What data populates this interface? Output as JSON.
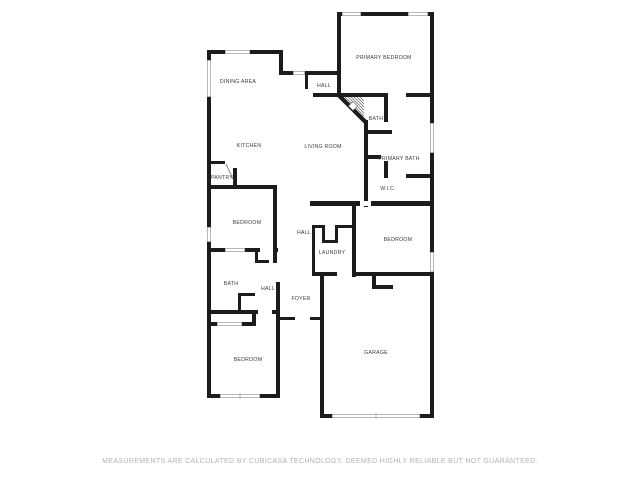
{
  "meta": {
    "width": 640,
    "height": 480
  },
  "colors": {
    "background": "#ffffff",
    "wall": "#1c1c1c",
    "label": "#3a3a3a",
    "window_line": "#999999",
    "stairs_line": "#555555",
    "footer_text": "#b3b3b3"
  },
  "floor_plan": {
    "rooms": [
      {
        "id": "dining-area",
        "label": "DINING AREA",
        "x": 238,
        "y": 81
      },
      {
        "id": "hall-upper",
        "label": "HALL",
        "x": 324,
        "y": 85
      },
      {
        "id": "primary-bedroom",
        "label": "PRIMARY BEDROOM",
        "x": 384,
        "y": 57
      },
      {
        "id": "kitchen",
        "label": "KITCHEN",
        "x": 249,
        "y": 145
      },
      {
        "id": "living-room",
        "label": "LIVING ROOM",
        "x": 323,
        "y": 146
      },
      {
        "id": "bath-suite",
        "label": "BATH",
        "x": 376,
        "y": 118
      },
      {
        "id": "primary-bath",
        "label": "PRIMARY BATH",
        "x": 399,
        "y": 158
      },
      {
        "id": "wic",
        "label": "W.I.C.",
        "x": 388,
        "y": 188
      },
      {
        "id": "pantry",
        "label": "PANTRY",
        "x": 222,
        "y": 177
      },
      {
        "id": "bedroom-left",
        "label": "BEDROOM",
        "x": 247,
        "y": 222
      },
      {
        "id": "hall-middle",
        "label": "HALL",
        "x": 304,
        "y": 232
      },
      {
        "id": "laundry",
        "label": "LAUNDRY",
        "x": 332,
        "y": 252
      },
      {
        "id": "bedroom-right",
        "label": "BEDROOM",
        "x": 398,
        "y": 239
      },
      {
        "id": "bath-lower",
        "label": "BATH",
        "x": 231,
        "y": 283
      },
      {
        "id": "hall-lower",
        "label": "HALL",
        "x": 268,
        "y": 288
      },
      {
        "id": "foyer",
        "label": "FOYER",
        "x": 301,
        "y": 298
      },
      {
        "id": "bedroom-lower",
        "label": "BEDROOM",
        "x": 248,
        "y": 359
      },
      {
        "id": "garage",
        "label": "GARAGE",
        "x": 376,
        "y": 352
      }
    ],
    "walls": [
      [
        207,
        50,
        76,
        4
      ],
      [
        207,
        50,
        4,
        348
      ],
      [
        279,
        50,
        4,
        25
      ],
      [
        279,
        71,
        16,
        4
      ],
      [
        305,
        71,
        36,
        4
      ],
      [
        305,
        71,
        3,
        18
      ],
      [
        337,
        12,
        4,
        85
      ],
      [
        337,
        12,
        97,
        4
      ],
      [
        430,
        12,
        4,
        406
      ],
      [
        313,
        93,
        121,
        4
      ],
      [
        364,
        120,
        4,
        87
      ],
      [
        384,
        95,
        4,
        27
      ],
      [
        364,
        130,
        28,
        4
      ],
      [
        364,
        155,
        28,
        4
      ],
      [
        384,
        155,
        4,
        23
      ],
      [
        406,
        174,
        24,
        4
      ],
      [
        310,
        201,
        124,
        5
      ],
      [
        352,
        201,
        4,
        76
      ],
      [
        312,
        225,
        3,
        50
      ],
      [
        312,
        225,
        10,
        3
      ],
      [
        322,
        225,
        3,
        18
      ],
      [
        322,
        240,
        16,
        3
      ],
      [
        335,
        225,
        3,
        18
      ],
      [
        338,
        225,
        14,
        3
      ],
      [
        312,
        272,
        25,
        4
      ],
      [
        352,
        272,
        82,
        4
      ],
      [
        372,
        276,
        4,
        13
      ],
      [
        372,
        285,
        21,
        4
      ],
      [
        320,
        272,
        4,
        146
      ],
      [
        320,
        414,
        14,
        4
      ],
      [
        420,
        414,
        14,
        4
      ],
      [
        211,
        161,
        14,
        3
      ],
      [
        233,
        168,
        4,
        20
      ],
      [
        211,
        185,
        66,
        4
      ],
      [
        273,
        185,
        4,
        78
      ],
      [
        276,
        282,
        4,
        116
      ],
      [
        207,
        248,
        71,
        4
      ],
      [
        255,
        248,
        3,
        15
      ],
      [
        255,
        260,
        14,
        3
      ],
      [
        238,
        293,
        17,
        3
      ],
      [
        238,
        293,
        3,
        18
      ],
      [
        207,
        310,
        73,
        4
      ],
      [
        252,
        313,
        4,
        12
      ],
      [
        207,
        322,
        49,
        4
      ],
      [
        207,
        394,
        73,
        4
      ],
      [
        278,
        317,
        17,
        3
      ],
      [
        310,
        317,
        12,
        3
      ]
    ],
    "door_gaps": [
      [
        388,
        93,
        18,
        4
      ],
      [
        260,
        248,
        13,
        4
      ],
      [
        258,
        310,
        14,
        4
      ],
      [
        360,
        201,
        11,
        5
      ]
    ],
    "windows": [
      {
        "rect": [
          225,
          50,
          25,
          4
        ],
        "tick": false
      },
      {
        "rect": [
          207,
          60,
          4,
          37
        ],
        "tick": false
      },
      {
        "rect": [
          293,
          71,
          12,
          4
        ],
        "tick": false
      },
      {
        "rect": [
          342,
          12,
          19,
          4
        ],
        "tick": false
      },
      {
        "rect": [
          408,
          12,
          20,
          4
        ],
        "tick": false
      },
      {
        "rect": [
          430,
          123,
          4,
          30
        ],
        "tick": false
      },
      {
        "rect": [
          207,
          227,
          4,
          15
        ],
        "tick": false
      },
      {
        "rect": [
          430,
          252,
          4,
          20
        ],
        "tick": false
      },
      {
        "rect": [
          220,
          394,
          40,
          4
        ],
        "tick": true
      },
      {
        "rect": [
          332,
          414,
          88,
          4
        ],
        "tick": true
      },
      {
        "rect": [
          225,
          248,
          20,
          4
        ],
        "tick": false
      },
      {
        "rect": [
          217,
          322,
          25,
          4
        ],
        "tick": false
      }
    ],
    "stairs": {
      "diagonal": [
        339,
        95.5,
        365.5,
        122
      ],
      "hatch_lines": [
        [
          342,
          97,
          364,
          119
        ],
        [
          345,
          97,
          364,
          116
        ],
        [
          348,
          97,
          364,
          113
        ],
        [
          351,
          97,
          364,
          110
        ],
        [
          354,
          97,
          364,
          107
        ],
        [
          357,
          97,
          364,
          104
        ],
        [
          360,
          97,
          364,
          101
        ]
      ],
      "diamond": {
        "x": 353,
        "y": 106,
        "size": 6.5
      }
    },
    "door_swing_lines": [
      [
        226,
        164,
        234,
        181
      ]
    ],
    "label_backgrounds": [
      [
        381,
        154,
        37,
        7
      ]
    ]
  },
  "footer": {
    "text": "MEASUREMENTS ARE CALCULATED BY CUBICASA TECHNOLOGY. DEEMED HIGHLY RELIABLE BUT NOT GUARANTEED."
  }
}
